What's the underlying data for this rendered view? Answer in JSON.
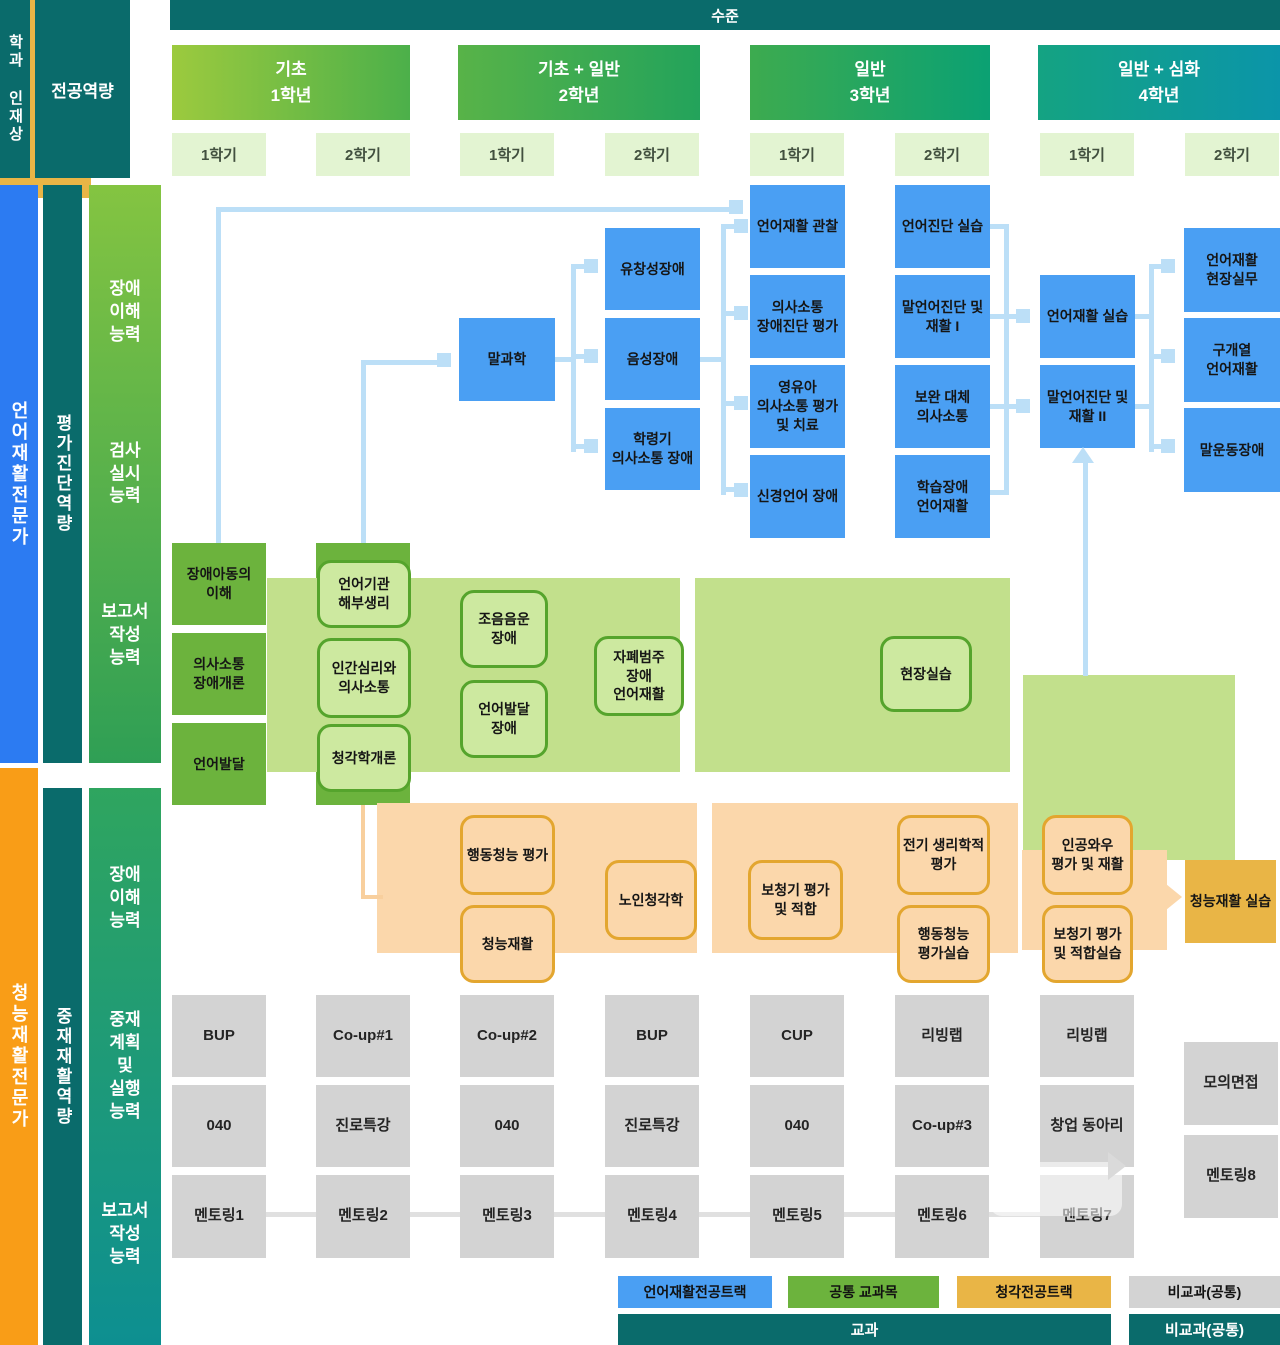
{
  "header": {
    "talent_label": "학과 인재상",
    "competency_label": "전공역량",
    "level_label": "수준",
    "grades": [
      {
        "level": "기초",
        "year": "1학년"
      },
      {
        "level": "기초 + 일반",
        "year": "2학년"
      },
      {
        "level": "일반",
        "year": "3학년"
      },
      {
        "level": "일반 + 심화",
        "year": "4학년"
      }
    ],
    "semesters": [
      "1학기",
      "2학기",
      "1학기",
      "2학기",
      "1학기",
      "2학기",
      "1학기",
      "2학기"
    ]
  },
  "sidebar_top": {
    "expert": "언어재활전문가",
    "competency": "평가진단역량",
    "abilities": [
      "장애\n이해\n능력",
      "검사\n실시\n능력",
      "보고서\n작성\n능력"
    ]
  },
  "sidebar_bottom": {
    "expert": "청능재활전문가",
    "competency": "중재재활역량",
    "abilities": [
      "장애\n이해\n능력",
      "중재\n계획\n및\n실행\n능력",
      "보고서\n작성\n능력"
    ]
  },
  "courses": {
    "speech": [
      "말과학",
      "유창성장애",
      "음성장애",
      "학령기 의사소통 장애",
      "언어재활 관찰",
      "의사소통 장애진단 평가",
      "영유아 의사소통 평가 및 치료",
      "신경언어 장애",
      "언어진단 실습",
      "말언어진단 및 재활 I",
      "보완 대체 의사소통",
      "학습장애 언어재활",
      "언어재활 실습",
      "말언어진단 및 재활 II",
      "언어재활 현장실무",
      "구개열 언어재활",
      "말운동장애"
    ],
    "common_dark": [
      "장애아동의 이해",
      "의사소통 장애개론",
      "언어발달"
    ],
    "common_round": [
      "언어기관 해부생리",
      "인간심리와 의사소통",
      "청각학개론",
      "조음음운 장애",
      "언어발달 장애",
      "자폐범주 장애 언어재활",
      "현장실습"
    ],
    "hearing": [
      "행동청능 평가",
      "청능재활",
      "노인청각학",
      "보청기 평가 및 적합",
      "전기 생리학적 평가",
      "행동청능 평가실습",
      "인공와우 평가 및 재활",
      "보청기 평가 및 적합실습"
    ],
    "hearing_practicum": "청능재활 실습",
    "noncurricular_row1": [
      "BUP",
      "Co-up#1",
      "Co-up#2",
      "BUP",
      "CUP",
      "리빙랩",
      "리빙랩"
    ],
    "noncurricular_row2": [
      "040",
      "진로특강",
      "040",
      "진로특강",
      "040",
      "Co-up#3",
      "창업 동아리"
    ],
    "noncurricular_row3": [
      "멘토링1",
      "멘토링2",
      "멘토링3",
      "멘토링4",
      "멘토링5",
      "멘토링6",
      "멘토링7"
    ],
    "noncurricular_extra": [
      "모의면접",
      "멘토링8"
    ]
  },
  "legend": {
    "items": [
      {
        "label": "언어재활전공트랙",
        "color": "#4a9ff3"
      },
      {
        "label": "공통 교과목",
        "color": "#6cb33d"
      },
      {
        "label": "청각전공트랙",
        "color": "#e9b546"
      },
      {
        "label": "비교과(공통)",
        "color": "#d3d3d3"
      }
    ],
    "curricular_label": "교과",
    "noncurricular_label": "비교과(공통)"
  }
}
